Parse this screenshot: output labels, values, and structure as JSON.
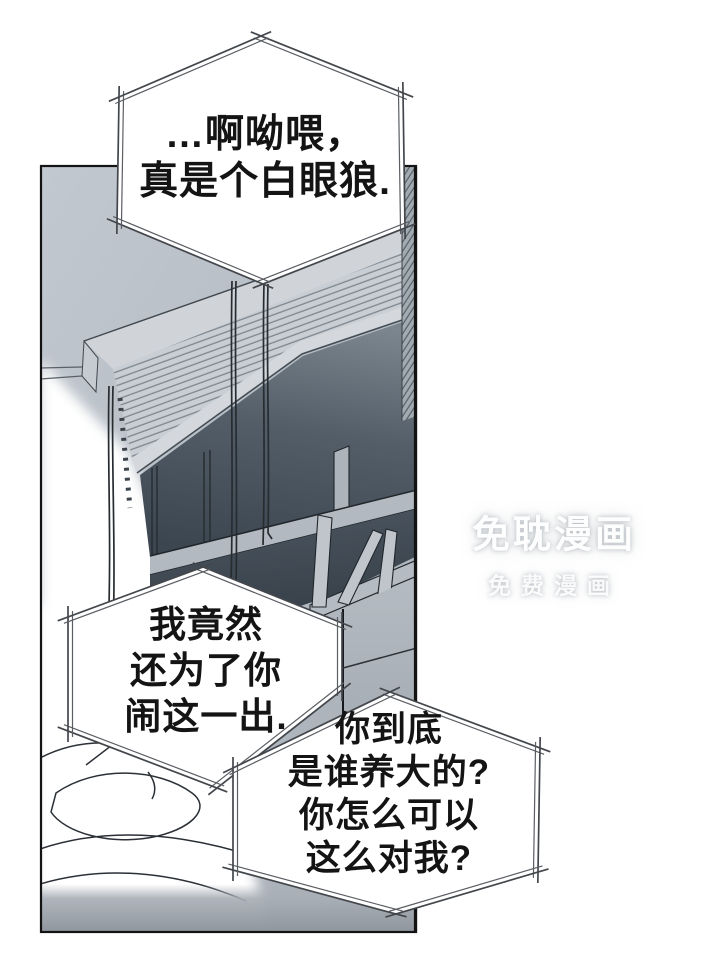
{
  "page": {
    "kind": "manhua-comic-page",
    "background_color": "#ffffff"
  },
  "speech_bubbles": [
    {
      "id": "top",
      "lines": [
        "…啊呦喂，",
        "真是个白眼狼."
      ]
    },
    {
      "id": "middle",
      "lines": [
        "我竟然",
        "还为了你",
        "闹这一出."
      ]
    },
    {
      "id": "bottom",
      "lines": [
        "你到底",
        "是谁养大的?",
        "你怎么可以",
        "这么对我?"
      ]
    }
  ],
  "watermark": {
    "title": "免耽漫画",
    "subtitle": "免费漫画"
  },
  "colors": {
    "bubble_fill": "#ffffff",
    "bubble_stroke_outer": "#43474c",
    "bubble_stroke_inner": "#5a5e63",
    "panel_border": "#131313",
    "wall": "#b7bec6",
    "blinds": "#c9ced4",
    "glass_dark": "#3c4650",
    "glass_mid": "#6c767f",
    "frame_light": "#b4bbc2",
    "floor": "#8e959d",
    "text": "#141414"
  }
}
